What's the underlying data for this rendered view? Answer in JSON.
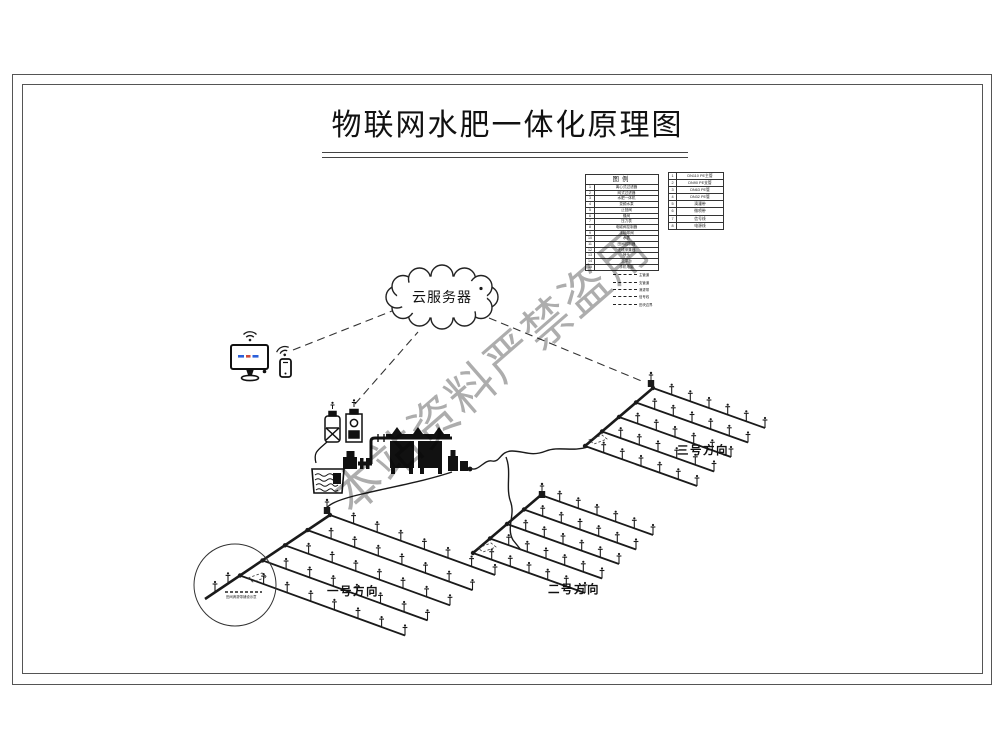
{
  "title": "物联网水肥一体化原理图",
  "watermark": "本站资料严禁盗用",
  "cloud": {
    "label": "云服务器"
  },
  "fields": [
    {
      "label": "一号方向"
    },
    {
      "label": "二号方向"
    },
    {
      "label": "三号方向"
    }
  ],
  "callout": {
    "note": "田间滴灌带铺设示意"
  },
  "legend": {
    "header": "图例",
    "rows": [
      {
        "num": "1",
        "label": "离心式过滤器"
      },
      {
        "num": "2",
        "label": "网式过滤器"
      },
      {
        "num": "3",
        "label": "水肥一体机"
      },
      {
        "num": "4",
        "label": "变频水泵"
      },
      {
        "num": "5",
        "label": "止回阀"
      },
      {
        "num": "6",
        "label": "蝶阀"
      },
      {
        "num": "7",
        "label": "压力表"
      },
      {
        "num": "8",
        "label": "电磁阀控制器"
      },
      {
        "num": "9",
        "label": "手动球阀"
      },
      {
        "num": "10",
        "label": "水表"
      },
      {
        "num": "11",
        "label": "田间控制器"
      },
      {
        "num": "12",
        "label": "无线采集器"
      },
      {
        "num": "13",
        "label": "喷头"
      },
      {
        "num": "14",
        "label": "云平台"
      },
      {
        "num": "15",
        "label": "手机电脑"
      }
    ],
    "rows2": [
      {
        "num": "1",
        "label": "DN110 PE主管"
      },
      {
        "num": "2",
        "label": "DN90 PE支管"
      },
      {
        "num": "3",
        "label": "DN63 PE管"
      },
      {
        "num": "4",
        "label": "DN32 PE管"
      },
      {
        "num": "5",
        "label": "滴灌带"
      },
      {
        "num": "6",
        "label": "微喷带"
      },
      {
        "num": "7",
        "label": "信号线"
      },
      {
        "num": "8",
        "label": "电源线"
      }
    ],
    "line_samples": [
      {
        "label": "主管道"
      },
      {
        "label": "支管道"
      },
      {
        "label": "滴灌带"
      },
      {
        "label": "信号线"
      },
      {
        "label": "田块边界"
      }
    ]
  },
  "colors": {
    "screen_blue": "#2b5fd9",
    "screen_red": "#d04a3a",
    "line": "#1a1a1a"
  }
}
